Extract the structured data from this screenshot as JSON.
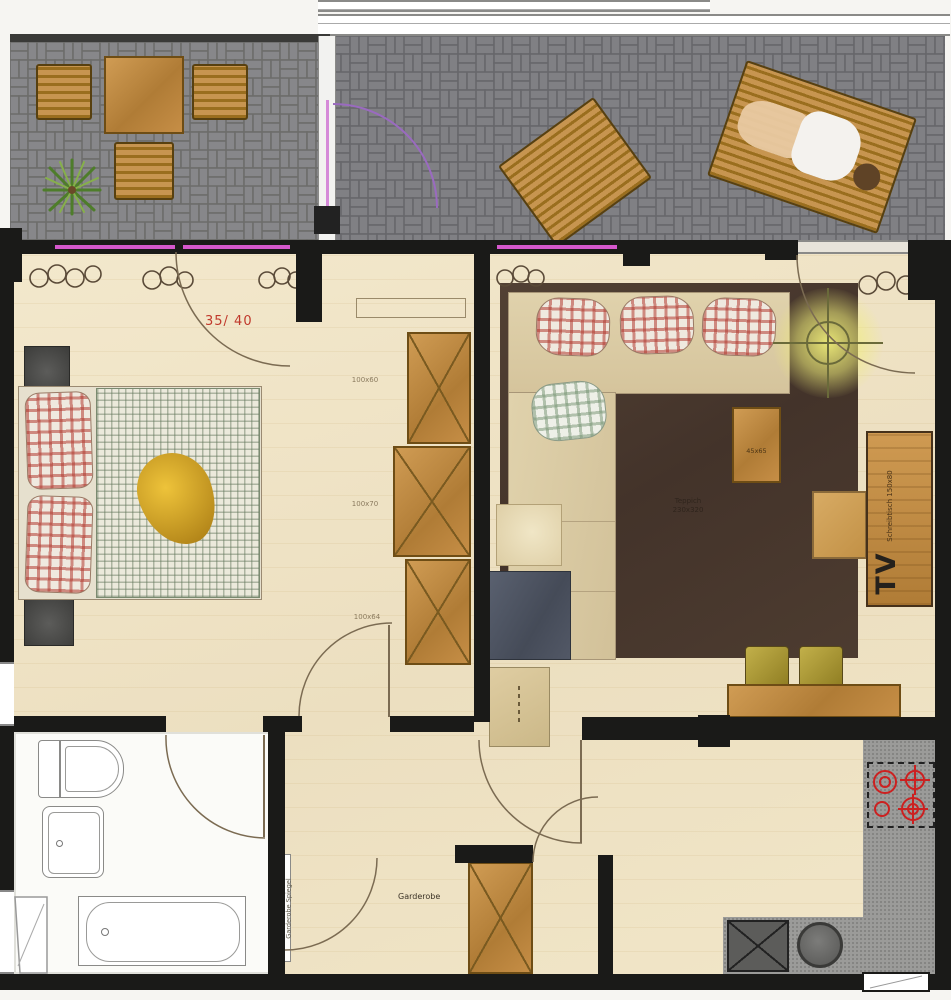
{
  "title": "apartment-floor-plan",
  "labels": {
    "bedroom_door_dim": "35/ 40",
    "wardrobe_1_dim": "100x60",
    "wardrobe_2_dim": "100x70",
    "wardrobe_3_dim": "100x64",
    "rug_name": "Teppich",
    "rug_dim": "230x320",
    "side_table_dim": "45x65",
    "desk_name": "Schreibtisch",
    "desk_dim": "150x80",
    "tv": "TV",
    "hall_closet": "Garderobe",
    "mirror_line1": "Garderobe",
    "mirror_line2": "Spiegel"
  },
  "colors": {
    "wall": "#1a1a18",
    "floor_wood": "#f1e6c8",
    "paving_gray": "#8c8c8a",
    "rug_brown": "#4a3a2f",
    "sofa_beige": "#dccca6",
    "furniture_wood": "#c68e46",
    "accent_red": "#c0392b",
    "glazing_magenta": "#d558cc",
    "door_arc_purple": "#9a6ac0",
    "lamp_glow_yellow": "#f0ee7a",
    "chair_olive": "#b3a23c",
    "counter_gray": "#9b9b99",
    "burner_red": "#cc2020"
  }
}
